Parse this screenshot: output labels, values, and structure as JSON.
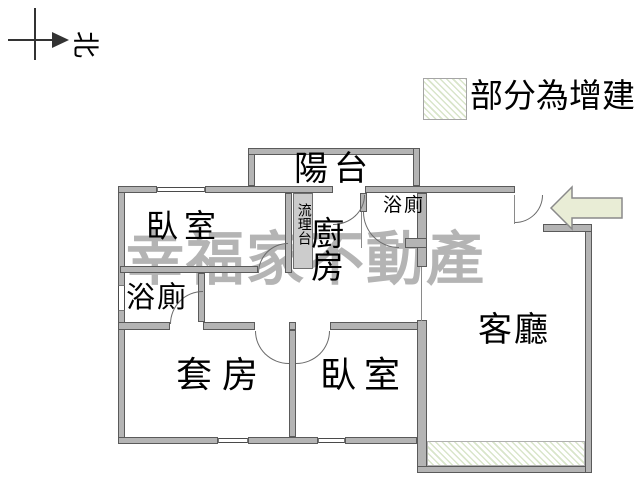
{
  "compass": {
    "north_label": "北"
  },
  "legend": {
    "label": "部分為增建"
  },
  "watermark": {
    "text": "幸福家不動產"
  },
  "rooms": {
    "balcony": "陽台",
    "bedroom_top": "臥室",
    "kitchen": "廚房",
    "counter": "流理台",
    "bath_kitchen": "浴廁",
    "bath_left": "浴廁",
    "suite": "套房",
    "bedroom_bottom": "臥室",
    "living": "客廳"
  },
  "colors": {
    "wall_fill": "#b4b4b4",
    "wall_outline": "#5a5a5a",
    "hatch_green": "#d9e5ca",
    "entrance_arrow_fill": "#e9edd6",
    "watermark_gray": "#b4b4b4"
  },
  "annotations": {
    "entrance_arrow_direction": "left"
  }
}
